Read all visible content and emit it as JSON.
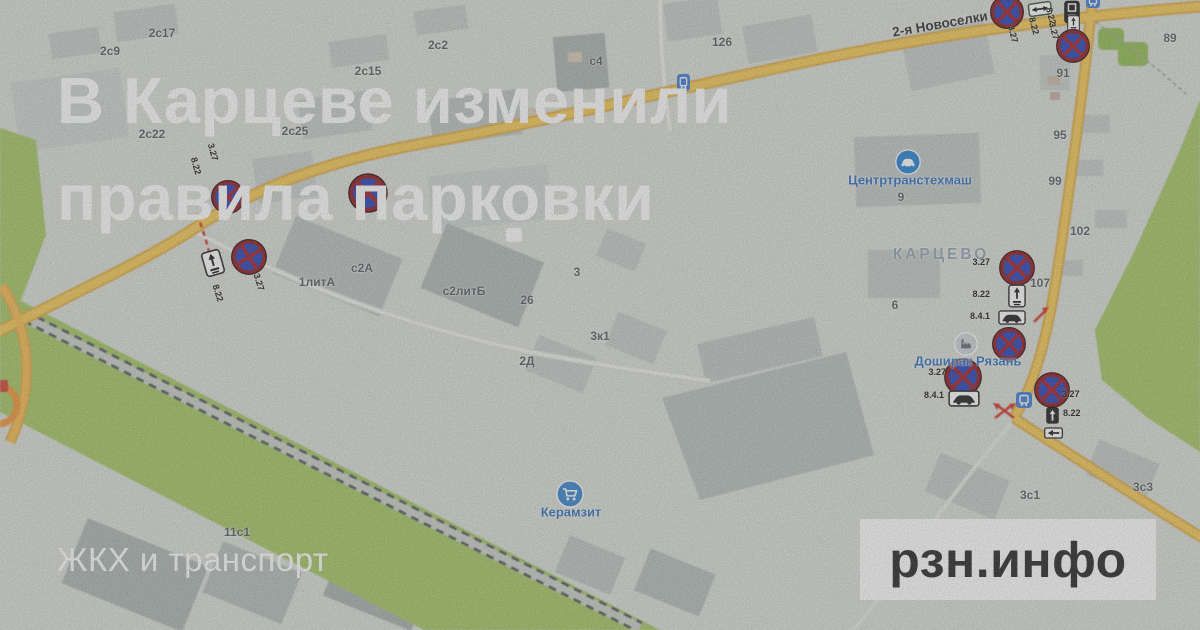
{
  "title": {
    "line1": "В Карцеве изменили",
    "line2": "правила парковки"
  },
  "category_label": "ЖКХ и транспорт",
  "brand_logo": "рзн.инфо",
  "map": {
    "street_label": "2-я Новоселки",
    "district_label": "КАРЦЕВО",
    "pois": [
      {
        "name": "Центртранстехмаш",
        "icon": "car-service-icon"
      },
      {
        "name": "Доширак Рязань",
        "icon": "factory-icon"
      },
      {
        "name": "Керамзит",
        "icon": "store-cart-icon"
      }
    ],
    "building_labels": [
      "2с9",
      "2с17",
      "2с2",
      "с4",
      "126",
      "2с15",
      "2с22",
      "2с25",
      "1литА",
      "с2А",
      "с2литБ",
      "3",
      "26",
      "3к1",
      "2Д",
      "9",
      "95",
      "99",
      "102",
      "107",
      "91",
      "89",
      "6",
      "11с1",
      "3с1",
      "3с3"
    ],
    "sign_clusters": [
      {
        "location": "west-road-upper",
        "codes": [
          "3.27",
          "8.22"
        ]
      },
      {
        "location": "west-road-bend",
        "codes": [
          "3.27",
          "8.22"
        ]
      },
      {
        "location": "novoselki-west",
        "codes": [
          "3.27",
          "8.22"
        ]
      },
      {
        "location": "novoselki-east",
        "codes": [
          "8.22",
          "3.27"
        ]
      },
      {
        "location": "street-107",
        "codes": [
          "3.27",
          "8.22",
          "8.4.1"
        ]
      },
      {
        "location": "doshirak",
        "codes": [
          "3.27",
          "8.4.1"
        ]
      },
      {
        "location": "junction-southeast",
        "codes": [
          "3.27",
          "8.22"
        ]
      }
    ],
    "colors": {
      "map_bg": "#d9ddd6",
      "green": "#a2c55e",
      "road_yellow": "#f4c74f",
      "poi_blue": "#2f80cc",
      "sign_ring_red": "#8e1014",
      "sign_fill_blue": "#1e3ab2",
      "logo_bg": "#ffffff",
      "logo_text": "#1c1c1c",
      "title_color": "#ffffff"
    }
  }
}
